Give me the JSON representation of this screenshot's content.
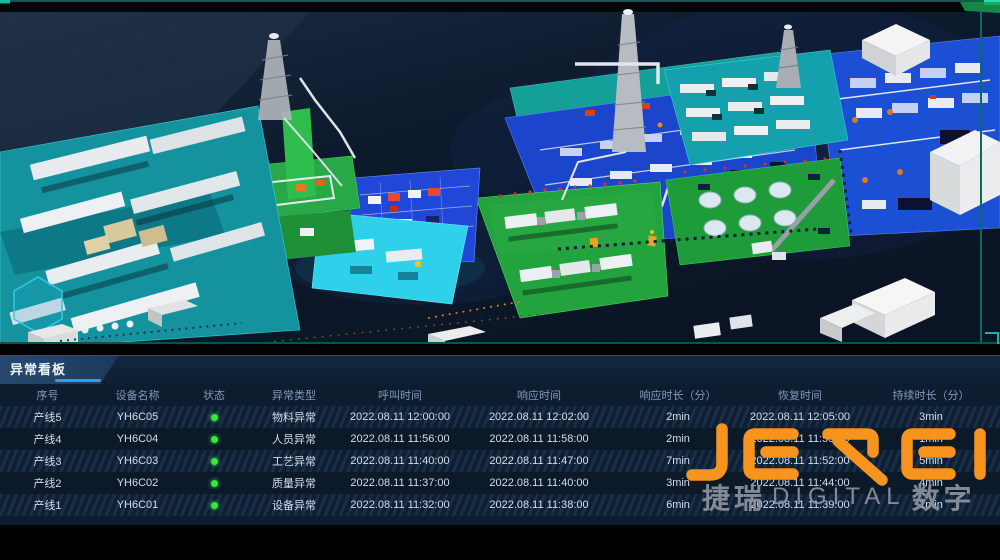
{
  "scene": {
    "name": "工厂三维数字孪生视图",
    "frame_color": "#19b7a3",
    "background_color": "#0d1a2d",
    "zone_colors": {
      "teal_platform": "#14939e",
      "green_platform": "#23a33e",
      "blue_platform": "#1b46cc",
      "cyan_platform": "#2ed0ea",
      "warehouse_white": "#f2f2f2"
    }
  },
  "panel": {
    "title": "异常看板",
    "accent_underline_color": "#2e9cf4",
    "status_dot_color": "#35e83a",
    "columns": [
      "序号",
      "设备名称",
      "状态",
      "异常类型",
      "呼叫时间",
      "响应时间",
      "响应时长（分）",
      "恢复时间",
      "持续时长（分）"
    ],
    "rows": [
      {
        "seq": "产线5",
        "device": "YH6C05",
        "status": "green",
        "type": "物料异常",
        "call_time": "2022.08.11 12:00:00",
        "response_time": "2022.08.11 12:02:00",
        "response_duration": "2min",
        "recover_time": "2022.08.11 12:05:00",
        "total_duration": "3min"
      },
      {
        "seq": "产线4",
        "device": "YH6C04",
        "status": "green",
        "type": "人员异常",
        "call_time": "2022.08.11 11:56:00",
        "response_time": "2022.08.11 11:58:00",
        "response_duration": "2min",
        "recover_time": "2022.08.11 11:59:00",
        "total_duration": "1min"
      },
      {
        "seq": "产线3",
        "device": "YH6C03",
        "status": "green",
        "type": "工艺异常",
        "call_time": "2022.08.11 11:40:00",
        "response_time": "2022.08.11 11:47:00",
        "response_duration": "7min",
        "recover_time": "2022.08.11 11:52:00",
        "total_duration": "5min"
      },
      {
        "seq": "产线2",
        "device": "YH6C02",
        "status": "green",
        "type": "质量异常",
        "call_time": "2022.08.11 11:37:00",
        "response_time": "2022.08.11 11:40:00",
        "response_duration": "3min",
        "recover_time": "2022.08.11 11:44:00",
        "total_duration": "4min"
      },
      {
        "seq": "产线1",
        "device": "YH6C01",
        "status": "green",
        "type": "设备异常",
        "call_time": "2022.08.11 11:32:00",
        "response_time": "2022.08.11 11:38:00",
        "response_duration": "6min",
        "recover_time": "2022.08.11 11:39:00",
        "total_duration": "1min"
      }
    ]
  },
  "watermark": {
    "logo_text": "JEREI",
    "logo_color": "#F7941D",
    "sub_left": "捷瑞",
    "sub_mid": "DIGITAL",
    "sub_right": "数字"
  }
}
